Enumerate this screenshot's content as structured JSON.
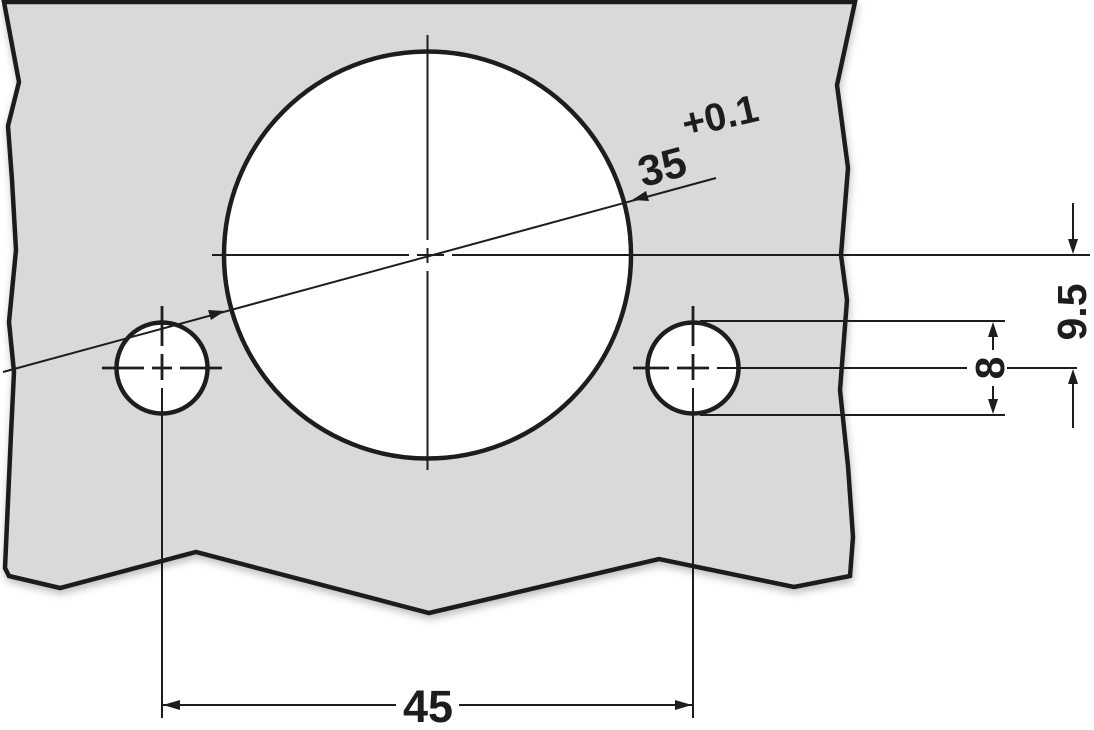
{
  "drawing": {
    "kind": "technical-drilling-pattern",
    "dimensions": {
      "cup_diameter": "35",
      "cup_diameter_tolerance": "+0.1",
      "hole_spacing": "45",
      "screw_hole_diameter": "8",
      "cup_center_to_screw_center": "9.5"
    },
    "colors": {
      "panel_fill": "#d9d9d9",
      "line": "#1d1d1b",
      "background": "#ffffff"
    }
  }
}
